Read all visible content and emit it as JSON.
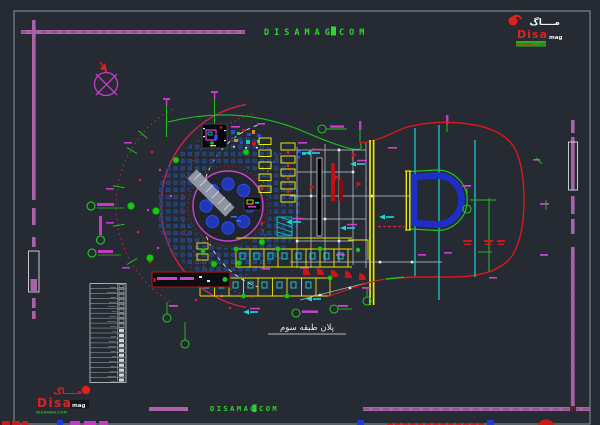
{
  "page": {
    "bg": "#262b33",
    "frame_color": "#8f949c",
    "ruler_color": "#a862a8"
  },
  "watermark_top": {
    "left": "DISAMAG",
    "right": "COM",
    "color": "#2ed52e"
  },
  "watermark_bottom": {
    "left": "DISAMAG",
    "right": "COM",
    "color": "#2ed52e"
  },
  "logo_top_right": {
    "arabic": "مــــاگ",
    "name": "Disa",
    "suffix": "mag",
    "tagline": "DISAMAG,COM"
  },
  "logo_bottom_left": {
    "arabic": "مــــاگ",
    "name": "Disa",
    "suffix": "mag",
    "tagline": "DISAMAG,COM"
  },
  "title_block": {
    "title": "پلان طبقه سوم"
  },
  "legend": {
    "rows": [
      {
        "label": "ـــــــ"
      },
      {
        "label": "ــــــــــ"
      },
      {
        "label": "ــــــ"
      },
      {
        "label": "ــــــــ"
      },
      {
        "label": "ـــــــــ"
      },
      {
        "label": "ـــــ"
      },
      {
        "label": "ــــــــ"
      },
      {
        "label": "ــــــــــ"
      },
      {
        "label": "ـــــــ"
      },
      {
        "label": "ــــ"
      },
      {
        "label": "ــــــ"
      },
      {
        "label": "ــــــــ"
      },
      {
        "label": "ـــــــــ"
      },
      {
        "label": "ــــــ"
      },
      {
        "label": "ـــــ"
      },
      {
        "label": "ــــــــ"
      },
      {
        "label": "ــــــ"
      },
      {
        "label": "ـــــــ"
      },
      {
        "label": "ــــــــــ"
      },
      {
        "label": "ــــــ"
      }
    ]
  },
  "colors": {
    "red": "#d81a1a",
    "crimson": "#cf2050",
    "magenta": "#d040d0",
    "cyan": "#18d8d8",
    "yellow": "#e8e800",
    "green": "#20c020",
    "blue": "#2747d8",
    "navy_seat": "#1c3c74",
    "white": "#e6e9ee",
    "gray": "#9aa0a8"
  }
}
